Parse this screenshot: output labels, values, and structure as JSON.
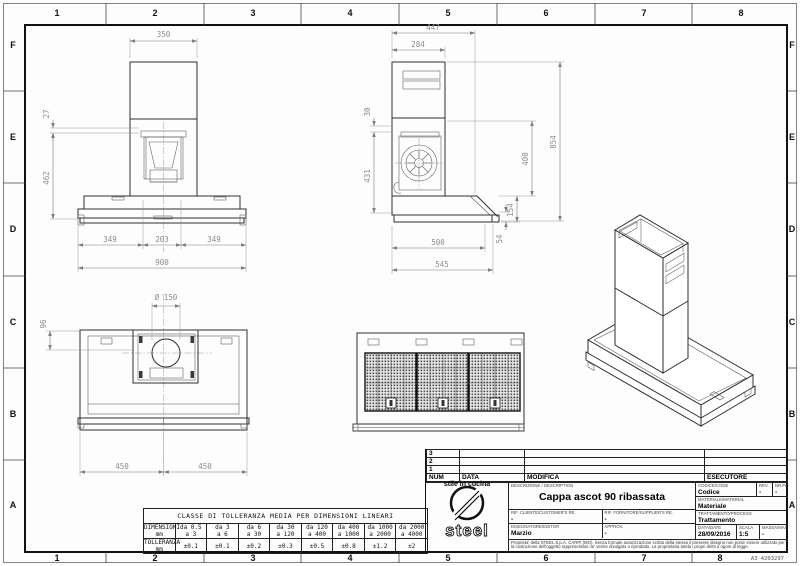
{
  "sheet": {
    "grid_columns": [
      "1",
      "2",
      "3",
      "4",
      "5",
      "6",
      "7",
      "8"
    ],
    "grid_rows": [
      "F",
      "E",
      "D",
      "C",
      "B",
      "A"
    ],
    "sheet_code": "A3 4203297"
  },
  "dims": {
    "front_top_width": "350",
    "front_offset": "27",
    "front_height": "462",
    "front_left": "349",
    "front_center": "203",
    "front_right": "349",
    "front_total": "900",
    "side_total_width": "447",
    "side_chimney_width": "284",
    "side_offset": "30",
    "side_body_height": "431",
    "side_total_height": "854",
    "side_chimney_height": "400",
    "side_canopy_height": "154",
    "side_lip_height": "54",
    "side_canopy_width": "500",
    "side_total_depth": "545",
    "plan_duct_diameter": "Ø 150",
    "plan_offset": "96",
    "plan_left": "450",
    "plan_right": "450"
  },
  "tolerance_table": {
    "title": "CLASSE DI TOLLERANZA MEDIA PER DIMENSIONI LINEARI",
    "dim_label": "DIMENSIONI\nmm",
    "tol_label": "TOLLERANZA\nmm",
    "ranges": [
      "da 0.5\na 3",
      "da 3\na 6",
      "da 6\na 30",
      "da 30\na 120",
      "da 120\na 400",
      "da 400\na 1000",
      "da 1000\na 2000",
      "da 2000\na 4000"
    ],
    "tolerances": [
      "±0.1",
      "±0.1",
      "±0.2",
      "±0.3",
      "±0.5",
      "±0.8",
      "±1.2",
      "±2"
    ]
  },
  "revision_table": {
    "rows": [
      "3",
      "2",
      "1"
    ],
    "headers": {
      "num": "NUM",
      "data": "DATA",
      "modifica": "MODIFICA",
      "esecutore": "ESECUTORE"
    }
  },
  "title_block": {
    "logo_text": "steel",
    "logo_subtitle": "stile in cucina",
    "description_label": "DESCRIZIONE / DESCRIPTION",
    "description": "Cappa ascot 90 ribassata",
    "code_label": "CODICE/CODE",
    "code": "Codice",
    "rev_label": "REV.",
    "rev": "-",
    "fo_label": "NR.FO.",
    "fo": "-",
    "material_label": "MATERIALE/MATERIAL",
    "material": "Materiale",
    "treatment_label": "TRATTAMENTO/PROCESS",
    "treatment": "Trattamento",
    "customer_ref_label": "RIF. CLIENTE/CUSTOMER'S RE.",
    "customer_ref": "-",
    "supplier_ref_label": "RIF. FORNITORE/SUPPLIER'S RE.",
    "supplier_ref": "-",
    "designer_label": "DISEGNATORE/EDITOR",
    "designer": "Marzio",
    "approv_label": "APPROV.",
    "approv": "-",
    "date_label": "DATA/DATE",
    "date": "28/09/2016",
    "scale_label": "SCALA",
    "scale": "1:5",
    "mass_label": "MASSA/MASS kg",
    "mass": "-",
    "legal": "Proprieta' della STEEL S.p.A. CARPI (MO). Senza formale autorizzazione scritta della stessa il presente disegno non potra' essere utilizzato per la costruzione dell'oggetto rappresentato ne' venire divulgato o riprodotto. La proprietaria tutela i propri diritti a rigore di legge."
  }
}
